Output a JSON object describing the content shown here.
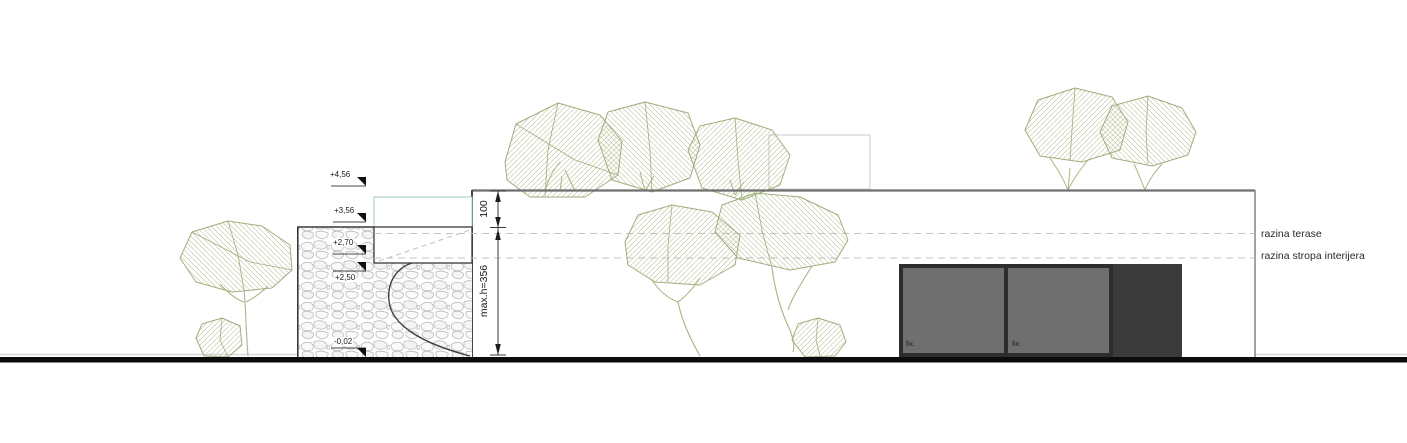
{
  "drawing": {
    "type": "architectural-elevation",
    "levels": [
      {
        "label": "+4,56"
      },
      {
        "label": "+3,56"
      },
      {
        "label": "+2,70"
      },
      {
        "label": "+2,50"
      },
      {
        "label": "-0,02"
      }
    ],
    "dimensions": {
      "roof_band": "100",
      "max_height": "max.h=356"
    },
    "annotations": {
      "terrace": "razina terase",
      "interior_ceiling": "razina stropa interijera"
    },
    "windows": {
      "pane1_label": "fix.",
      "pane2_label": "fix."
    },
    "colors": {
      "tree_hatch": "#a9b584",
      "glass": "#6f6f6f",
      "window_frame": "#2d2d2d",
      "dark_panel": "#3b3b3b",
      "railing_teal": "#a5cfc8",
      "ground": "#0c0c0c",
      "dashed_level": "#c3c3c3",
      "stone_outline": "#bcbcbc"
    }
  }
}
